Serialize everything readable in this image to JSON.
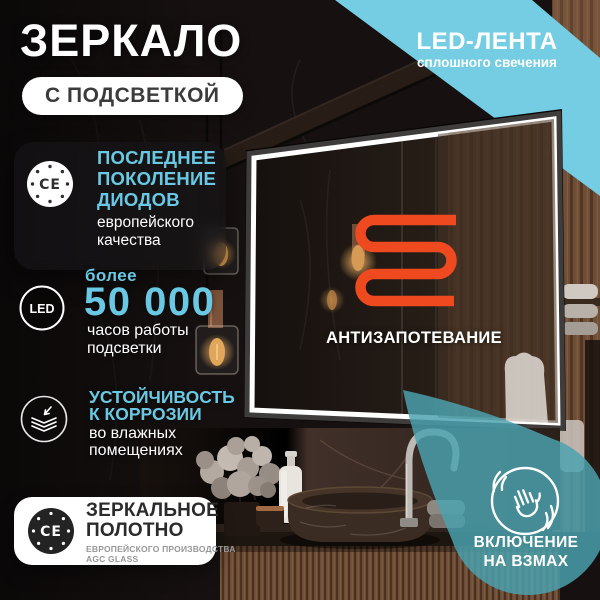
{
  "colors": {
    "accent": "#69c8e4",
    "ribbon": "#74cde3",
    "coil": "#ef4a1f",
    "blob": "rgba(74,162,176,0.83)"
  },
  "header": {
    "title": "ЗЕРКАЛО",
    "badge": "С ПОДСВЕТКОЙ"
  },
  "ribbon": {
    "title": "LED-ЛЕНТА",
    "subtitle": "сплошного свечения"
  },
  "feature_diodes": {
    "icon_label": "CE",
    "line1": "ПОСЛЕДНЕЕ",
    "line2": "ПОКОЛЕНИЕ",
    "line3": "ДИОДОВ",
    "sub1": "европейского",
    "sub2": "качества"
  },
  "feature_hours": {
    "icon_label": "LED",
    "pre": "более",
    "value": "50 000",
    "sub1": "часов работы",
    "sub2": "подсветки"
  },
  "feature_corrosion": {
    "line1": "УСТОЙЧИВОСТЬ",
    "line2": "К КОРРОЗИИ",
    "sub1": "во влажных",
    "sub2": "помещениях"
  },
  "feature_glass": {
    "icon_label": "CE",
    "line1": "ЗЕРКАЛЬНОЕ",
    "line2": "ПОЛОТНО",
    "sub1": "ЕВРОПЕЙСКОГО ПРОИЗВОДСТВА",
    "sub2": "AGC GLASS"
  },
  "antifog": {
    "label": "АНТИЗАПОТЕВАНИЕ"
  },
  "wave": {
    "line1": "ВКЛЮЧЕНИЕ",
    "line2": "НА ВЗМАХ"
  }
}
